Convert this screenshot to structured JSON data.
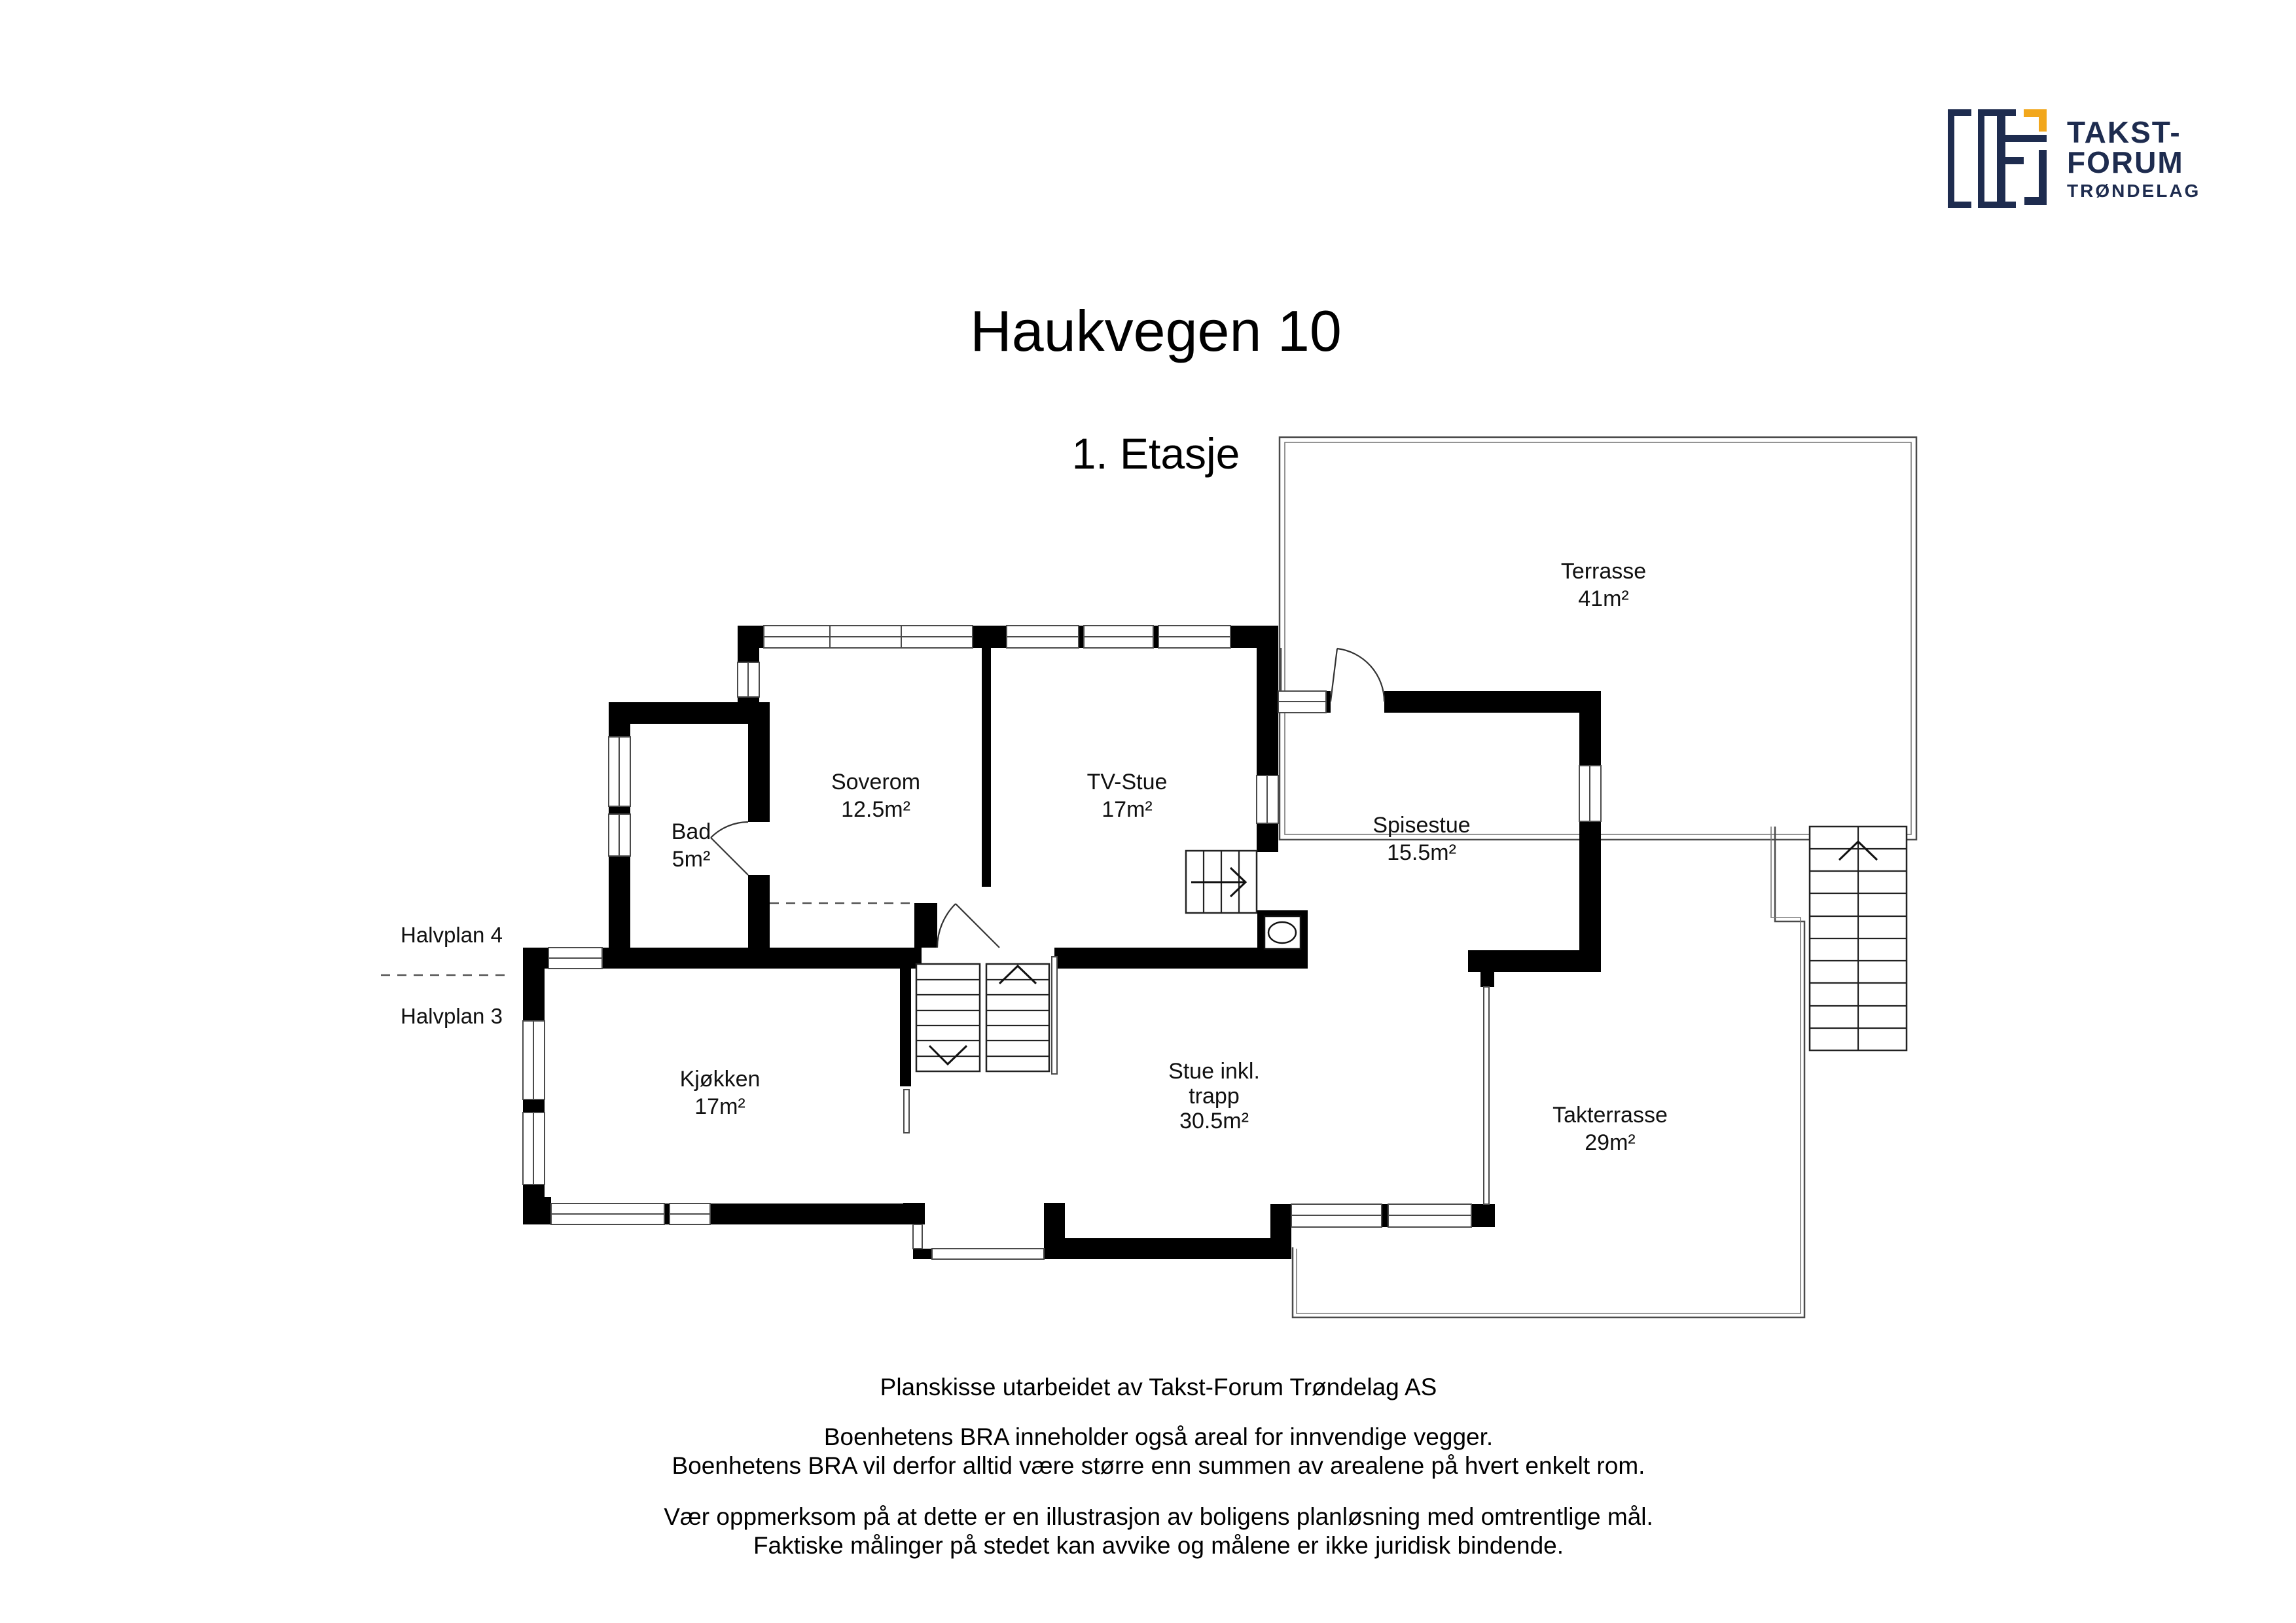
{
  "logo": {
    "brand_lines": [
      "TAKST-",
      "FORUM",
      "TRØNDELAG"
    ],
    "colors": {
      "navy": "#1e2c4f",
      "orange": "#f2a71c"
    }
  },
  "header": {
    "title": "Haukvegen 10",
    "subtitle": "1. Etasje"
  },
  "plan": {
    "levels": [
      "Halvplan 4",
      "Halvplan 3"
    ],
    "rooms": [
      {
        "name": "Terrasse",
        "area": "41m²"
      },
      {
        "name": "Soverom",
        "area": "12.5m²"
      },
      {
        "name": "TV-Stue",
        "area": "17m²"
      },
      {
        "name": "Bad",
        "area": "5m²"
      },
      {
        "name": "Spisestue",
        "area": "15.5m²"
      },
      {
        "name": "Kjøkken",
        "area": "17m²"
      },
      {
        "name": "Stue inkl. trapp",
        "area": "30.5m²",
        "lines": [
          "Stue inkl.",
          "trapp",
          "30.5m²"
        ]
      },
      {
        "name": "Takterrasse",
        "area": "29m²"
      }
    ]
  },
  "footer": {
    "lines": [
      "Planskisse utarbeidet av Takst-Forum Trøndelag AS",
      "Boenhetens BRA inneholder også areal for innvendige vegger.",
      "Boenhetens BRA vil derfor alltid være større enn summen av arealene på hvert enkelt rom.",
      "Vær oppmerksom på at dette er en illustrasjon av boligens planløsning med omtrentlige mål.",
      "Faktiske målinger på stedet kan avvike og målene er ikke juridisk bindende."
    ]
  }
}
